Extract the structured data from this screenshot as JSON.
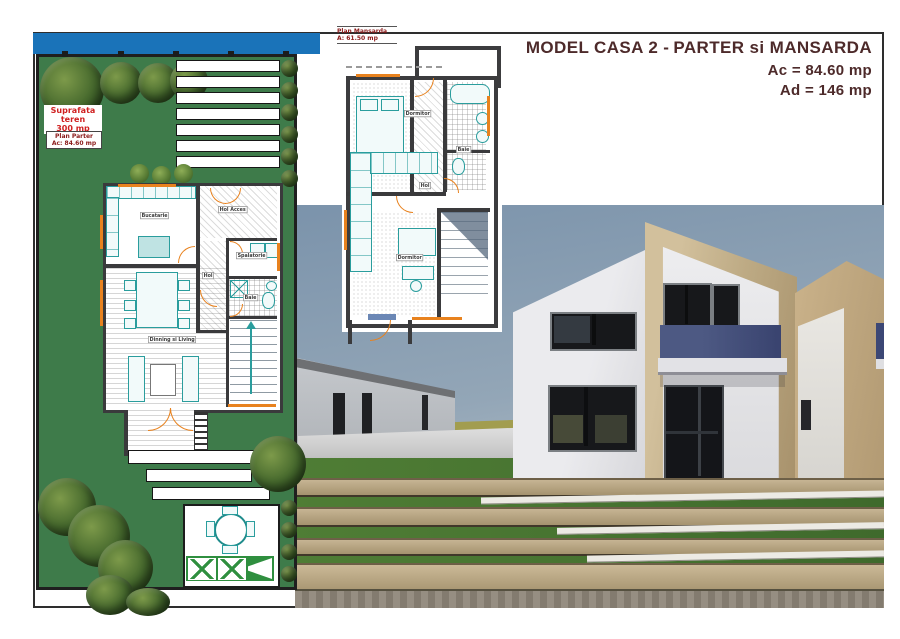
{
  "header": {
    "model_name": "MODEL CASA 2 -",
    "floors": "PARTER si MANSARDA",
    "built_area": "Ac = 84.60 mp",
    "total_area": "Ad = 146 mp"
  },
  "site_plan": {
    "surface_label": "Suprafata teren",
    "surface_value": "300 mp",
    "plan_title": "Plan Parter",
    "plan_area": "Ac: 84.60 mp",
    "rooms": {
      "kitchen": "Bucatarie",
      "entry_hall": "Hol Acces",
      "laundry": "Spalatorie",
      "hall": "Hol",
      "bathroom": "Baie",
      "living": "Dinning si Living"
    }
  },
  "attic_plan": {
    "title": "Plan Mansarda",
    "area": "A: 61.50 mp",
    "rooms": {
      "bedroom1": "Dormitor",
      "bathroom": "Baie",
      "hall": "Hol",
      "bedroom2": "Dormitor"
    }
  },
  "colors": {
    "accent_maroon": "#4d2a2a",
    "road_blue": "#1a73b9",
    "garden_green": "#3e7b4a",
    "balcony_blue": "#3c4775",
    "plan_orange": "#e8821e",
    "plan_teal": "#2a9d9d",
    "wood_tan": "#b8a47e"
  }
}
